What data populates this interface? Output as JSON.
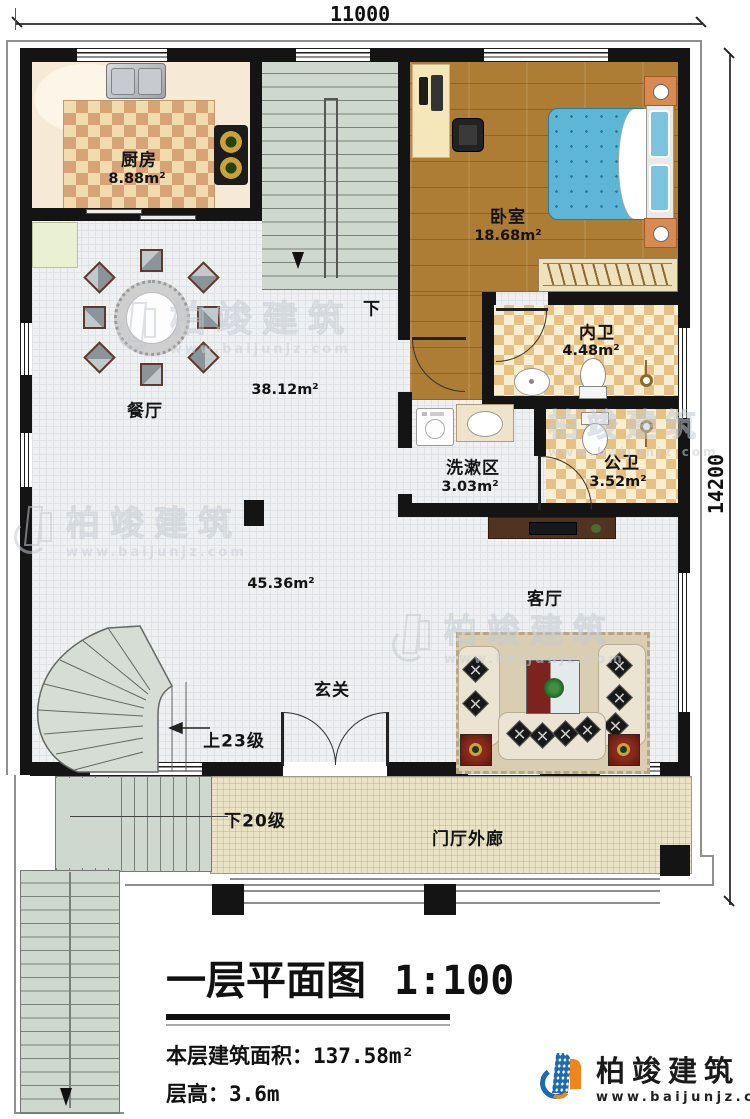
{
  "dimensions": {
    "top": "11000",
    "right": "14200"
  },
  "rooms": {
    "kitchen": {
      "label": "厨房",
      "area": "8.88m²"
    },
    "bedroom": {
      "label": "卧室",
      "area": "18.68m²"
    },
    "ensuite": {
      "label": "内卫",
      "area": "4.48m²"
    },
    "wash": {
      "label": "洗漱区",
      "area": "3.03m²"
    },
    "public_bath": {
      "label": "公卫",
      "area": "3.52m²"
    },
    "dining": {
      "label": "餐厅",
      "area": "38.12m²"
    },
    "living": {
      "label": "客厅",
      "area": "45.36m²"
    },
    "foyer": {
      "label": "玄关"
    },
    "porch": {
      "label": "门厅外廊"
    }
  },
  "stairs": {
    "down": "下",
    "up": "上23级",
    "down20": "下20级"
  },
  "titleblock": {
    "title": "一层平面图",
    "scale": "1:100",
    "area_label": "本层建筑面积：",
    "area_value": "137.58m²",
    "height_label": "层高：",
    "height_value": "3.6m"
  },
  "brand": {
    "name": "柏竣建筑",
    "website": "www.baijunjz.com"
  }
}
